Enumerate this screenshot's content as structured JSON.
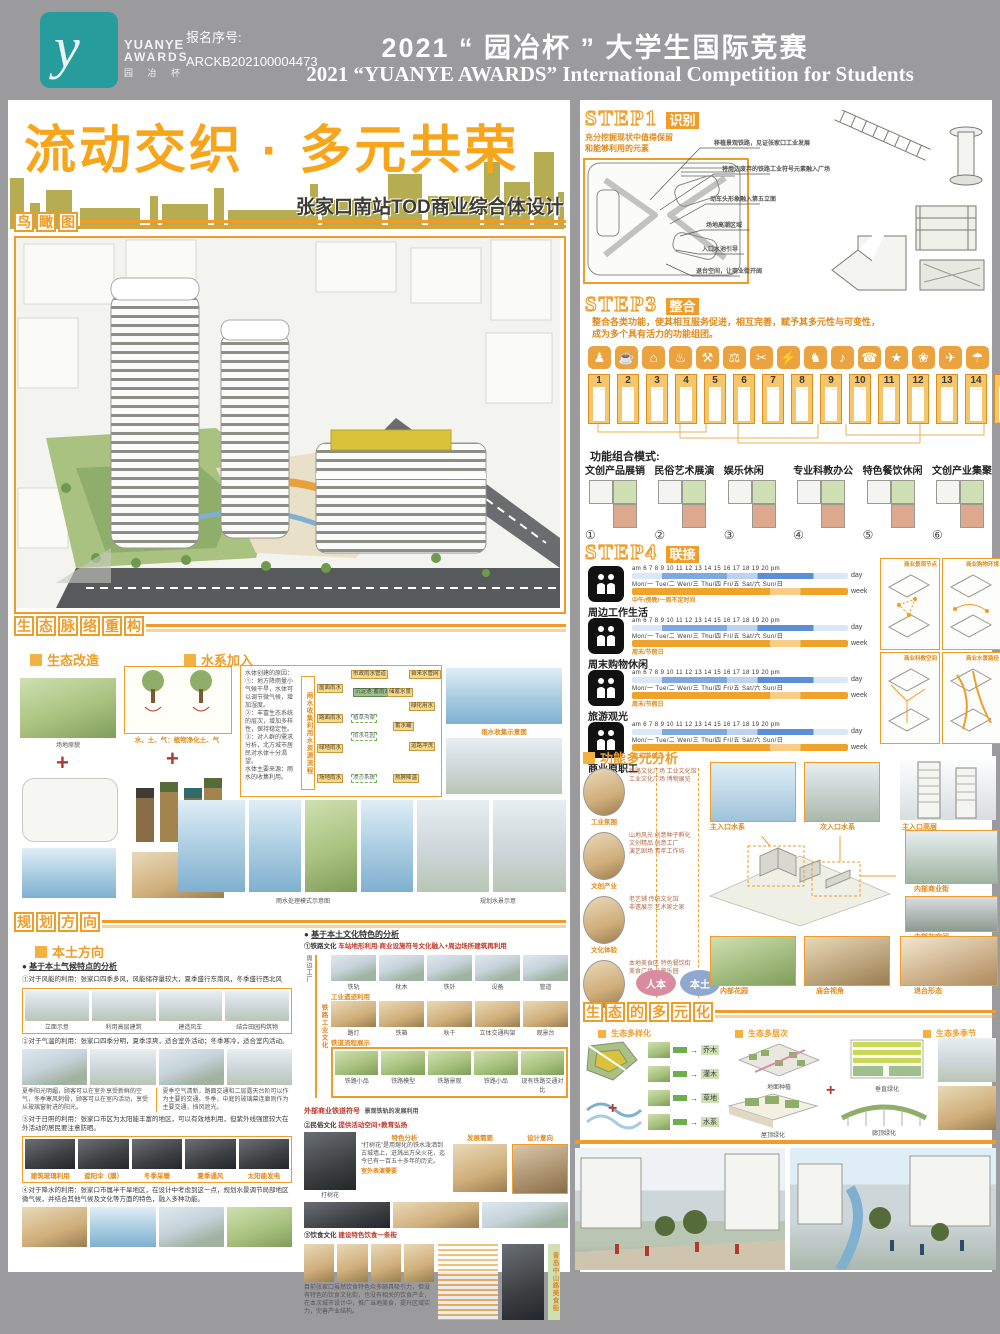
{
  "header": {
    "reg_label": "报名序号:",
    "reg_no": "ARCKB202100004473",
    "logo_1": "YUANYE",
    "logo_2": "AWARDS",
    "logo_3": "园 冶 杯",
    "logo_glyph": "y",
    "title_cn": "2021 “ 园冶杯 ” 大学生国际竞赛",
    "title_en": "2021 “YUANYE AWARDS” International Competition for  Students"
  },
  "hero": {
    "title": "流动交织 · 多元共荣",
    "subtitle": "张家口南站TOD商业综合体设计"
  },
  "aerial": {
    "header": "鸟瞰图"
  },
  "step1": {
    "step": "STEP1",
    "badge": "识别",
    "intro": "充分挖掘现状中值得保留\n和能够利用的元素",
    "callouts": [
      "移植景观铁路，见证张家口工业发展",
      "将周边废弃的铁路工业符号元素融入广场",
      "动车头形象融入第五立面",
      "场地高潮区域",
      "入口水池引导",
      "退台空间，让商业街开阔"
    ]
  },
  "step3": {
    "step": "STEP3",
    "badge": "整合",
    "intro": "整合各类功能，使其相互服务促进，相互完善，赋予其多元性与可变性，\n成为多个具有活力的功能组团。",
    "tiles": [
      {
        "n": "1",
        "g": "♟"
      },
      {
        "n": "2",
        "g": "☕"
      },
      {
        "n": "3",
        "g": "⌂"
      },
      {
        "n": "4",
        "g": "♨"
      },
      {
        "n": "5",
        "g": "⚒"
      },
      {
        "n": "6",
        "g": "⚖"
      },
      {
        "n": "7",
        "g": "✂"
      },
      {
        "n": "8",
        "g": "⚡"
      },
      {
        "n": "9",
        "g": "♞"
      },
      {
        "n": "10",
        "g": "♪"
      },
      {
        "n": "11",
        "g": "☎"
      },
      {
        "n": "12",
        "g": "★"
      },
      {
        "n": "13",
        "g": "❀"
      },
      {
        "n": "14",
        "g": "✈"
      },
      {
        "n": "15",
        "g": "☂"
      }
    ],
    "modes_title": "功能组合模式:",
    "modes": [
      {
        "n": "①",
        "label": "文创产品展销"
      },
      {
        "n": "②",
        "label": "民俗艺术展演"
      },
      {
        "n": "③",
        "label": "娱乐休闲"
      },
      {
        "n": "④",
        "label": "专业科教办公"
      },
      {
        "n": "⑤",
        "label": "特色餐饮休闲"
      },
      {
        "n": "⑥",
        "label": "文创产业集聚"
      }
    ]
  },
  "step4": {
    "step": "STEP4",
    "badge": "联接",
    "scale_day": "am 6 7 8 9 10 11 12 13 14 15 16 17 18 19 20 pm",
    "scale_week": "Mon/一 Tue/二 Wen/三 Thu/四 Fri/五 Sat/六 Sun/日",
    "day": "day",
    "week": "week",
    "rows": [
      {
        "label": "周边工作生活",
        "note": "中午/傍晚/一周不定时间"
      },
      {
        "label": "周末购物休闲",
        "note": "周末/节假日"
      },
      {
        "label": "旅游观光",
        "note": "周末/节假日"
      },
      {
        "label": "商业原职工",
        "note": "周末/节假日"
      }
    ],
    "panels": [
      "商业景观节点",
      "商业购物环境",
      "商业科教空间",
      "商业水景路径"
    ]
  },
  "multi": {
    "header": "功能多元分析",
    "circles": [
      {
        "label": "工业氛围",
        "lines": "铁路文化广场 工业文化馆\n工业文化广场 博物展览"
      },
      {
        "label": "文创产业",
        "lines": "山地风光 创意种子孵化\n文创精品 创意工厂\n演艺剧场 青年工作坊"
      },
      {
        "label": "文化体验",
        "lines": "老艺铺 传统文化馆\n非遗展示 艺术家之家"
      },
      {
        "label": "生态休闲",
        "lines": "本地美食区 特色餐饮街\n美食广场 儿童乐园"
      }
    ],
    "pole_1": "人本",
    "pole_2": "本土",
    "photos": {
      "p1": "主入口水系",
      "p2": "次入口水系",
      "p3": "主入口高层",
      "p4": "内部商业街",
      "p5": "内部灰空间",
      "p6": "内部花园",
      "p7": "庙会视角",
      "p8": "退台形态"
    }
  },
  "eco_multi": {
    "header": "生态的多元化",
    "subs": [
      "生态多样化",
      "生态多层次",
      "生态多季节"
    ],
    "tags": [
      {
        "label": "乔木"
      },
      {
        "label": "灌木"
      },
      {
        "label": "草地"
      },
      {
        "label": "水系"
      }
    ],
    "labels": {
      "l1": "地面种植",
      "l2": "垂直绿化",
      "l3": "屋顶绿化",
      "l4": "廊顶绿化"
    },
    "plus": "+"
  },
  "eco": {
    "header": "生态脉络重构",
    "transform": {
      "title": "生态改造",
      "site": "场地原貌",
      "tree": "水、土、气：植物净化土、气",
      "plus": "+"
    },
    "water": {
      "title": "水系加入",
      "para": "水体创建的原因：\n①：地方降雨量小气候干旱，水体可以调节微气候，增加湿度。\n②：丰富生态系统的层次，增加多样性，保持稳定性。\n③：对人群的需求分析，北方城市居民对水体十分渴望。\n水体主要来源：雨水的收集利用。",
      "vert": "雨水收集利用水资源流程",
      "flow": [
        "屋面雨水",
        "路面雨水",
        "绿地雨水",
        "场地雨水",
        "市政雨水管道",
        "沉淀池·蓄雨池",
        "植草沟渠",
        "雨水花园",
        "渗沙系统",
        "蓄水罐",
        "绿化用水",
        "道路冲洗",
        "热屏降温",
        "自来水管网",
        "储蓄水景"
      ],
      "collect": "雨水收集示意图",
      "cap_left": "雨水处理模式示意图",
      "cap_right": "规划水景示意"
    }
  },
  "plan": {
    "header": "规划方向",
    "local_title": "本土方向",
    "climate": {
      "title": "基于本土气候特点的分析",
      "i1": "①对于风能的利用：张家口四季多风，风能储存量较大，夏季盛行东南风，冬季盛行西北风",
      "strip1": [
        "立面示意",
        "利用高层建筑",
        "建造风车",
        "结合田园构筑物"
      ],
      "i2": "②对于气温的利用：张家口四季分明，夏季凉爽，适合室外活动；冬季寒冷，适合室内活动。",
      "b1": "夏季阳光明媚，顾客可以在室外享受新鲜的空气，冬季寒风刺骨，顾客可以在室内活动，享受从玻璃窗射进的阳光。",
      "b2": "夏季空气清新，路面交通和二层露天台阶可以作为主要的交通。冬季，中庭的玻璃幕连廊则作为主要交通，挡风遮光。",
      "i3": "③对于日照的利用：张家口市区为太阳能丰富的地区，可以有效地利用，但紫外线强度较大在外活动的居民要注意防晒。",
      "strip3": [
        "建筑玻璃利用",
        "遮阳伞（膜）",
        "冬季采暖",
        "夏季通风",
        "太阳能发电"
      ],
      "i4": "④对于降水的利用：张家口市属半干旱地区，在设计中考虑到这一点，规划水景调节局部地区微气候，并结合其他气候及文化等方面的特色，融入多种功能。"
    },
    "culture": {
      "title": "基于本土文化特色的分析",
      "rail_label": "①铁路文化",
      "rail_desc": "车站地形利用·商业设施符号文化融入+周边场所建筑再利用",
      "side1": "周边工厂",
      "side2": "铁路工业文化",
      "branch1": "工业遗迹利用",
      "branch2": "铁道流程展示",
      "row1": [
        "铁轨",
        "枕木",
        "铁钎",
        "设备",
        "管道"
      ],
      "row2": [
        "路灯",
        "铁箱",
        "秋千",
        "立体交通构架",
        "观景台"
      ],
      "row3": [
        "铁路小品",
        "铁路模型",
        "铁路景观",
        "铁路小品",
        "现有铁路交通对比"
      ],
      "note1": "外部商业铁道符号",
      "note2": "景观铁轨的发展利用",
      "folk_label": "②民俗文化",
      "folk_desc": "提供活动空间+教育弘扬",
      "folk_cols": [
        "特色分析",
        "发展需要",
        "设计意向"
      ],
      "folk_photo": "打树花",
      "folk_para": "“打树花”是用熔化的铁水泼洒到古城墙上，迸溅出万朵火花，迄今已有一百五十多年的历史。",
      "folk_note": "室外表演需要",
      "food_label": "③饮食文化",
      "food_desc": "建设特色饮食一条街",
      "food_para": "目前张家口虽然饮食特色众多颇具吸引力，但没有特色的饮食文化街，也没有相关的饮食产业，在本次城市设计中，推广当地美食，提升区域实力，完善产业结构。",
      "food_vert": "青岛中山路美食街"
    }
  }
}
